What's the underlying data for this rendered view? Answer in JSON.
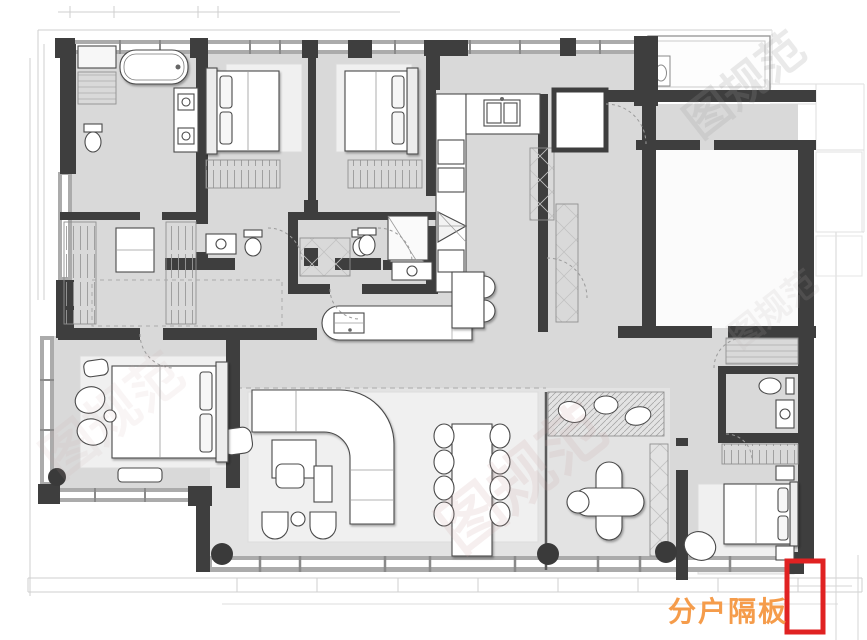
{
  "annotation": {
    "label": "分户隔板",
    "label_color": "#F59C4B",
    "box_color": "#E02222"
  },
  "watermark": {
    "text": "图规范"
  },
  "palette": {
    "wall": "#3E3E3E",
    "floor": "#D9D9D9",
    "living_floor": "#E3E3E3",
    "rug": "#F0F0F0",
    "window_band": "#ABABAB"
  }
}
